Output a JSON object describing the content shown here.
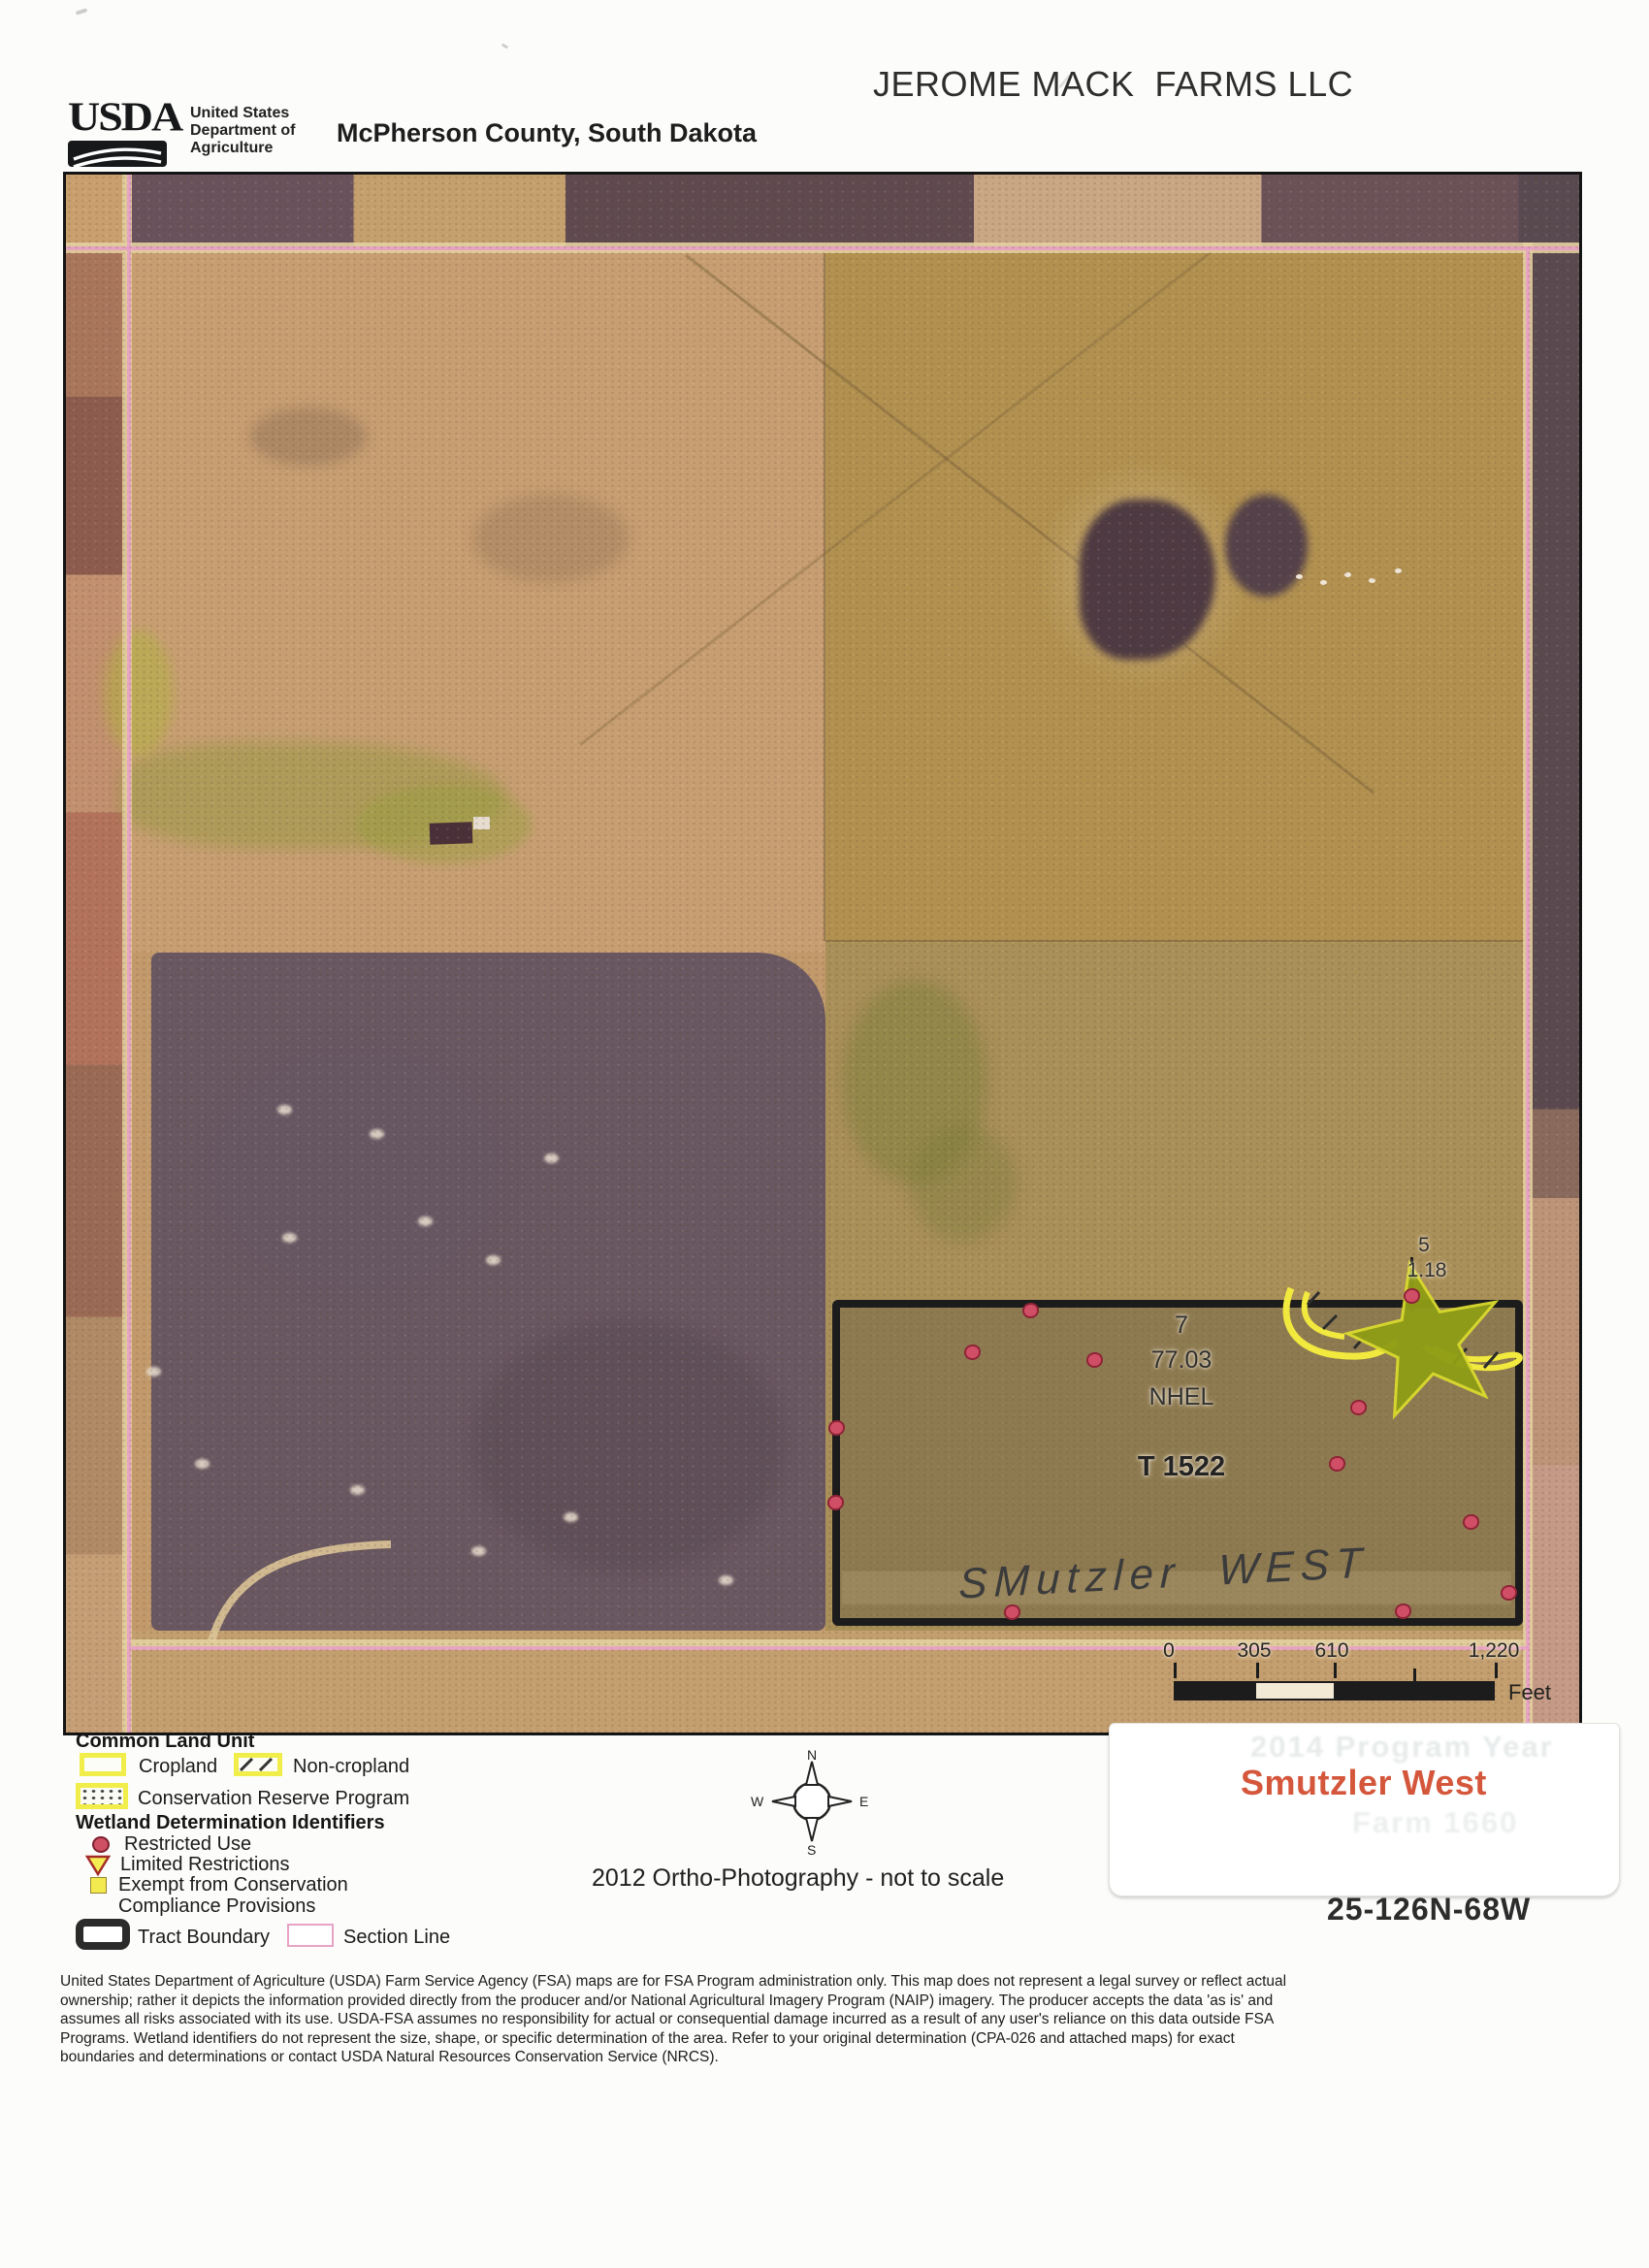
{
  "header": {
    "usda_wordmark": "USDA",
    "agency_lines": [
      "United States",
      "Department of",
      "Agriculture"
    ],
    "title": "JEROME MACK  FARMS LLC",
    "subtitle": "McPherson County, South Dakota"
  },
  "map": {
    "field_labels": {
      "field_number": "7",
      "field_acres": "77.03",
      "field_hel": "NHEL",
      "tract": "T 1522",
      "small_field_number": "5",
      "small_field_acres": "1.18",
      "handwritten": "SMutzler  WEST"
    },
    "wetland_points": [
      [
        994,
        1171
      ],
      [
        934,
        1214
      ],
      [
        1060,
        1222
      ],
      [
        794,
        1292
      ],
      [
        793,
        1369
      ],
      [
        1387,
        1156
      ],
      [
        1332,
        1271
      ],
      [
        1310,
        1329
      ],
      [
        1448,
        1389
      ],
      [
        1487,
        1462
      ],
      [
        1378,
        1481
      ],
      [
        975,
        1482
      ]
    ],
    "speckles": [
      [
        225,
        964
      ],
      [
        320,
        989
      ],
      [
        500,
        1014
      ],
      [
        370,
        1079
      ],
      [
        230,
        1096
      ],
      [
        440,
        1119
      ],
      [
        90,
        1234
      ],
      [
        140,
        1329
      ],
      [
        300,
        1356
      ],
      [
        520,
        1384
      ],
      [
        680,
        1449
      ],
      [
        425,
        1419
      ]
    ],
    "scale_bar": {
      "ticks": [
        "0",
        "305",
        "610",
        "1,220"
      ],
      "unit": "Feet"
    }
  },
  "legend": {
    "clu_title": "Common Land Unit",
    "cropland": "Cropland",
    "non_cropland": "Non-cropland",
    "crp": "Conservation Reserve Program",
    "wetland_title": "Wetland Determination Identifiers",
    "restricted": "Restricted Use",
    "limited": "Limited Restrictions",
    "exempt_line1": "Exempt from Conservation",
    "exempt_line2": "Compliance Provisions",
    "tract_boundary": "Tract Boundary",
    "section_line": "Section Line"
  },
  "compass": {
    "n": "N",
    "s": "S",
    "e": "E",
    "w": "W"
  },
  "ortho_note": "2012 Ortho-Photography - not to scale",
  "sticker": {
    "label": "Smutzler West",
    "ghost_line1": "2014 Program Year",
    "ghost_line2": "Farm 1660"
  },
  "plss": "25-126N-68W",
  "disclaimer_lines": [
    "United States Department of Agriculture (USDA) Farm Service Agency (FSA) maps are for FSA Program administration only.  This map does not represent a legal survey or reflect actual",
    "ownership; rather it depicts the information provided directly from the producer and/or National Agricultural Imagery Program (NAIP) imagery.  The producer accepts the data 'as is' and",
    "assumes all risks associated with its use.  USDA-FSA assumes no responsibility for actual or consequential damage incurred as a result of any user's reliance on this data outside FSA",
    "Programs.  Wetland identifiers do not represent the size, shape, or specific determination of the area.  Refer to your original determination (CPA-026 and attached maps) for exact",
    "boundaries and determinations or contact USDA Natural Resources Conservation Service (NRCS)."
  ],
  "colors": {
    "section_line": "#e7a0c5",
    "tract_boundary": "#1c1c1c",
    "wetland_dot": "#d14f66",
    "legend_yellow": "#f1ed4a",
    "sticker_label": "#d4573c",
    "star": "#8f9d16"
  }
}
